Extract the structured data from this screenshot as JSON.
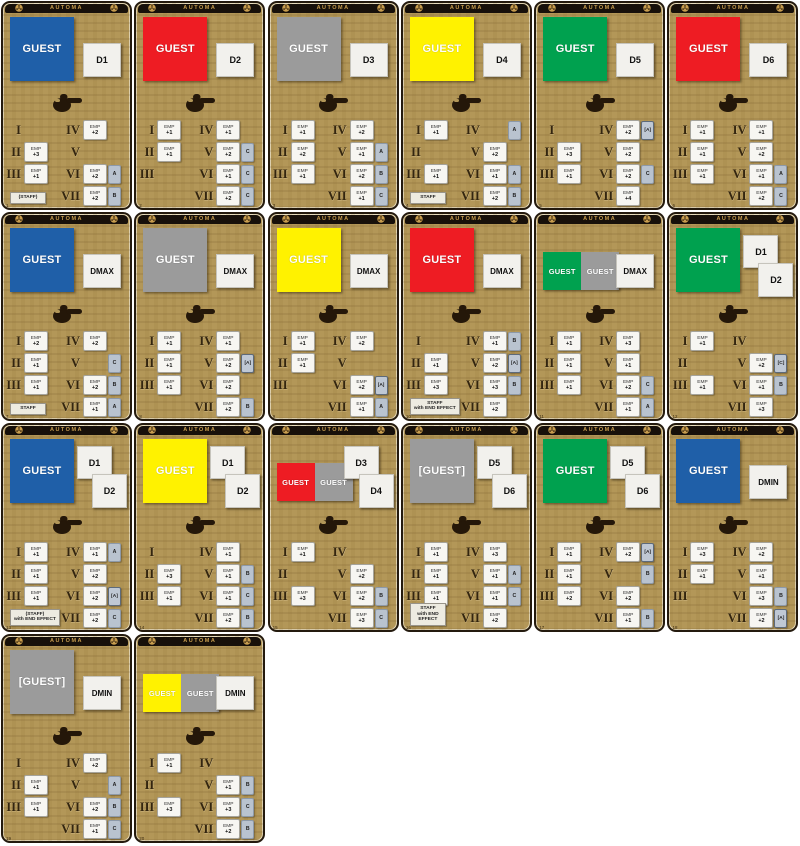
{
  "header": {
    "title": "AUTOMA"
  },
  "labels": {
    "emp": "EMP"
  },
  "numerals": [
    "I",
    "II",
    "III",
    "IV",
    "V",
    "VI",
    "VII"
  ],
  "colors": {
    "blue": "#1f5fa8",
    "red": "#ee1c23",
    "gray": "#9b9b9b",
    "yellow": "#fff200",
    "green": "#00a14f"
  },
  "icons": {
    "reel": "film-reel-icon",
    "hand": "pointing-hand-icon"
  },
  "cards": [
    {
      "num": "1",
      "guests": {
        "style": "single",
        "items": [
          {
            "color": "blue",
            "label": "GUEST"
          }
        ]
      },
      "dice": {
        "style": "single",
        "labels": [
          "D1"
        ]
      },
      "staff": {
        "lines": [
          "(STAFF)"
        ]
      },
      "rows": [
        null,
        {
          "emp": "+3"
        },
        {
          "emp": "+1"
        },
        {
          "emp": "+2"
        },
        null,
        {
          "emp": "+2",
          "tag": "A"
        },
        {
          "emp": "+2",
          "tag": "B"
        }
      ]
    },
    {
      "num": "2",
      "guests": {
        "style": "single",
        "items": [
          {
            "color": "red",
            "label": "GUEST"
          }
        ]
      },
      "dice": {
        "style": "single",
        "labels": [
          "D2"
        ]
      },
      "staff": null,
      "rows": [
        {
          "emp": "+1"
        },
        {
          "emp": "+1"
        },
        null,
        {
          "emp": "+1"
        },
        {
          "emp": "+2",
          "tag": "C"
        },
        {
          "emp": "+1",
          "tag": "C"
        },
        {
          "emp": "+2",
          "tag": "C"
        }
      ]
    },
    {
      "num": "3",
      "guests": {
        "style": "single",
        "items": [
          {
            "color": "gray",
            "label": "GUEST"
          }
        ]
      },
      "dice": {
        "style": "single",
        "labels": [
          "D3"
        ]
      },
      "staff": null,
      "rows": [
        {
          "emp": "+1"
        },
        {
          "emp": "+2"
        },
        {
          "emp": "+1"
        },
        {
          "emp": "+2"
        },
        {
          "emp": "+1",
          "tag": "A"
        },
        {
          "emp": "+2",
          "tag": "B"
        },
        {
          "emp": "+1",
          "tag": "C"
        }
      ]
    },
    {
      "num": "4",
      "guests": {
        "style": "single",
        "items": [
          {
            "color": "yellow",
            "label": "GUEST"
          }
        ]
      },
      "dice": {
        "style": "single",
        "labels": [
          "D4"
        ]
      },
      "staff": {
        "lines": [
          "STAFF"
        ]
      },
      "rows": [
        {
          "emp": "+1"
        },
        null,
        {
          "emp": "+1"
        },
        {
          "tag": "A"
        },
        {
          "emp": "+2"
        },
        {
          "emp": "+1",
          "tag": "A"
        },
        {
          "emp": "+2",
          "tag": "B"
        }
      ]
    },
    {
      "num": "5",
      "guests": {
        "style": "single",
        "items": [
          {
            "color": "green",
            "label": "GUEST"
          }
        ]
      },
      "dice": {
        "style": "single",
        "labels": [
          "D5"
        ]
      },
      "staff": null,
      "rows": [
        null,
        {
          "emp": "+3"
        },
        {
          "emp": "+1"
        },
        {
          "emp": "+2",
          "tag": "[A]"
        },
        {
          "emp": "+2"
        },
        {
          "emp": "+2",
          "tag": "C"
        },
        {
          "emp": "+4"
        }
      ]
    },
    {
      "num": "6",
      "guests": {
        "style": "single",
        "items": [
          {
            "color": "red",
            "label": "GUEST"
          }
        ]
      },
      "dice": {
        "style": "single",
        "labels": [
          "D6"
        ]
      },
      "staff": null,
      "rows": [
        {
          "emp": "+1"
        },
        {
          "emp": "+1"
        },
        {
          "emp": "+1"
        },
        {
          "emp": "+1"
        },
        {
          "emp": "+2"
        },
        {
          "emp": "+1",
          "tag": "A"
        },
        {
          "emp": "+2",
          "tag": "C"
        }
      ]
    },
    {
      "num": "7",
      "guests": {
        "style": "single",
        "items": [
          {
            "color": "blue",
            "label": "GUEST"
          }
        ]
      },
      "dice": {
        "style": "single",
        "labels": [
          "DMAX"
        ]
      },
      "staff": {
        "lines": [
          "STAFF"
        ]
      },
      "rows": [
        {
          "emp": "+2"
        },
        {
          "emp": "+1"
        },
        {
          "emp": "+1"
        },
        {
          "emp": "+2"
        },
        {
          "tag": "C"
        },
        {
          "emp": "+2",
          "tag": "B"
        },
        {
          "emp": "+1",
          "tag": "A"
        }
      ]
    },
    {
      "num": "8",
      "guests": {
        "style": "single",
        "items": [
          {
            "color": "gray",
            "label": "GUEST"
          }
        ]
      },
      "dice": {
        "style": "single",
        "labels": [
          "DMAX"
        ]
      },
      "staff": null,
      "rows": [
        {
          "emp": "+1"
        },
        {
          "emp": "+1"
        },
        {
          "emp": "+1"
        },
        {
          "emp": "+1"
        },
        {
          "emp": "+2",
          "tag": "[A]"
        },
        {
          "emp": "+2"
        },
        {
          "emp": "+2",
          "tag": "B"
        }
      ]
    },
    {
      "num": "9",
      "guests": {
        "style": "single",
        "items": [
          {
            "color": "yellow",
            "label": "GUEST"
          }
        ]
      },
      "dice": {
        "style": "single",
        "labels": [
          "DMAX"
        ]
      },
      "staff": null,
      "rows": [
        {
          "emp": "+1"
        },
        {
          "emp": "+1"
        },
        null,
        {
          "emp": "+2"
        },
        null,
        {
          "emp": "+2",
          "tag": "[A]"
        },
        {
          "emp": "+1",
          "tag": "A"
        }
      ]
    },
    {
      "num": "10",
      "guests": {
        "style": "single",
        "items": [
          {
            "color": "red",
            "label": "GUEST"
          }
        ]
      },
      "dice": {
        "style": "single",
        "labels": [
          "DMAX"
        ]
      },
      "staff": {
        "lines": [
          "STAFF",
          "with END EFFECT"
        ]
      },
      "rows": [
        null,
        {
          "emp": "+1"
        },
        {
          "emp": "+3"
        },
        {
          "emp": "+1",
          "tag": "B"
        },
        {
          "emp": "+2",
          "tag": "[A]"
        },
        {
          "emp": "+3",
          "tag": "B"
        },
        {
          "emp": "+2"
        }
      ]
    },
    {
      "num": "11",
      "guests": {
        "style": "double",
        "items": [
          {
            "color": "green",
            "label": "GUEST"
          },
          {
            "color": "gray",
            "label": "GUEST"
          }
        ]
      },
      "dice": {
        "style": "single",
        "labels": [
          "DMAX"
        ]
      },
      "staff": null,
      "rows": [
        {
          "emp": "+1"
        },
        {
          "emp": "+1"
        },
        {
          "emp": "+1"
        },
        {
          "emp": "+3"
        },
        {
          "emp": "+1"
        },
        {
          "emp": "+2",
          "tag": "C"
        },
        {
          "emp": "+1",
          "tag": "A"
        }
      ]
    },
    {
      "num": "12",
      "guests": {
        "style": "single",
        "items": [
          {
            "color": "green",
            "label": "GUEST"
          }
        ]
      },
      "dice": {
        "style": "double",
        "labels": [
          "D1",
          "D2"
        ]
      },
      "staff": null,
      "rows": [
        {
          "emp": "+1"
        },
        null,
        {
          "emp": "+1"
        },
        null,
        {
          "emp": "+2",
          "tag": "[C]"
        },
        {
          "emp": "+1",
          "tag": "B"
        },
        {
          "emp": "+3"
        }
      ]
    },
    {
      "num": "13",
      "guests": {
        "style": "single",
        "items": [
          {
            "color": "blue",
            "label": "GUEST"
          }
        ]
      },
      "dice": {
        "style": "double",
        "labels": [
          "D1",
          "D2"
        ]
      },
      "staff": {
        "lines": [
          "(STAFF)",
          "with END EFFECT"
        ]
      },
      "rows": [
        {
          "emp": "+1"
        },
        {
          "emp": "+1"
        },
        {
          "emp": "+1"
        },
        {
          "emp": "+1",
          "tag": "A"
        },
        {
          "emp": "+2"
        },
        {
          "emp": "+2",
          "tag": "[A]"
        },
        {
          "emp": "+2",
          "tag": "C"
        }
      ]
    },
    {
      "num": "14",
      "guests": {
        "style": "single",
        "items": [
          {
            "color": "yellow",
            "label": "GUEST"
          }
        ]
      },
      "dice": {
        "style": "double",
        "labels": [
          "D1",
          "D2"
        ]
      },
      "staff": null,
      "rows": [
        null,
        {
          "emp": "+3"
        },
        {
          "emp": "+1"
        },
        {
          "emp": "+1"
        },
        {
          "emp": "+1",
          "tag": "B"
        },
        {
          "emp": "+1",
          "tag": "C"
        },
        {
          "emp": "+2",
          "tag": "B"
        }
      ]
    },
    {
      "num": "15",
      "guests": {
        "style": "double",
        "items": [
          {
            "color": "red",
            "label": "GUEST"
          },
          {
            "color": "gray",
            "label": "GUEST"
          }
        ]
      },
      "dice": {
        "style": "double",
        "labels": [
          "D3",
          "D4"
        ]
      },
      "staff": null,
      "rows": [
        {
          "emp": "+1"
        },
        null,
        {
          "emp": "+3"
        },
        null,
        {
          "emp": "+2"
        },
        {
          "emp": "+2",
          "tag": "B"
        },
        {
          "emp": "+3",
          "tag": "C"
        }
      ]
    },
    {
      "num": "16",
      "guests": {
        "style": "single",
        "items": [
          {
            "color": "gray",
            "label": "[GUEST]"
          }
        ]
      },
      "dice": {
        "style": "double",
        "labels": [
          "D5",
          "D6"
        ]
      },
      "staff": {
        "lines": [
          "STAFF",
          "with END",
          "EFFECT"
        ]
      },
      "rows": [
        {
          "emp": "+1"
        },
        {
          "emp": "+1"
        },
        {
          "emp": "+1"
        },
        {
          "emp": "+3"
        },
        {
          "emp": "+1",
          "tag": "A"
        },
        {
          "emp": "+1",
          "tag": "C"
        },
        {
          "emp": "+2"
        }
      ]
    },
    {
      "num": "17",
      "guests": {
        "style": "single",
        "items": [
          {
            "color": "green",
            "label": "GUEST"
          }
        ]
      },
      "dice": {
        "style": "double",
        "labels": [
          "D5",
          "D6"
        ]
      },
      "staff": null,
      "rows": [
        {
          "emp": "+1"
        },
        {
          "emp": "+1"
        },
        {
          "emp": "+2"
        },
        {
          "emp": "+2",
          "tag": "[A]"
        },
        {
          "tag": "B"
        },
        {
          "emp": "+2"
        },
        {
          "emp": "+1",
          "tag": "B"
        }
      ]
    },
    {
      "num": "18",
      "guests": {
        "style": "single",
        "items": [
          {
            "color": "blue",
            "label": "GUEST"
          }
        ]
      },
      "dice": {
        "style": "single",
        "labels": [
          "DMIN"
        ]
      },
      "staff": null,
      "rows": [
        {
          "emp": "+3"
        },
        {
          "emp": "+1"
        },
        null,
        {
          "emp": "+2"
        },
        {
          "emp": "+1"
        },
        {
          "emp": "+3",
          "tag": "B"
        },
        {
          "emp": "+2",
          "tag": "[A]"
        }
      ]
    },
    {
      "num": "19",
      "guests": {
        "style": "single",
        "items": [
          {
            "color": "gray",
            "label": "[GUEST]"
          }
        ]
      },
      "dice": {
        "style": "single",
        "labels": [
          "DMIN"
        ]
      },
      "staff": null,
      "rows": [
        null,
        {
          "emp": "+1"
        },
        {
          "emp": "+1"
        },
        {
          "emp": "+2"
        },
        {
          "tag": "A"
        },
        {
          "emp": "+2",
          "tag": "B"
        },
        {
          "emp": "+1",
          "tag": "C"
        }
      ]
    },
    {
      "num": "20",
      "guests": {
        "style": "double",
        "items": [
          {
            "color": "yellow",
            "label": "GUEST"
          },
          {
            "color": "gray",
            "label": "GUEST"
          }
        ]
      },
      "dice": {
        "style": "single",
        "labels": [
          "DMIN"
        ]
      },
      "staff": null,
      "rows": [
        {
          "emp": "+1"
        },
        null,
        {
          "emp": "+3"
        },
        null,
        {
          "emp": "+1",
          "tag": "B"
        },
        {
          "emp": "+3",
          "tag": "C"
        },
        {
          "emp": "+2",
          "tag": "B"
        }
      ]
    }
  ]
}
